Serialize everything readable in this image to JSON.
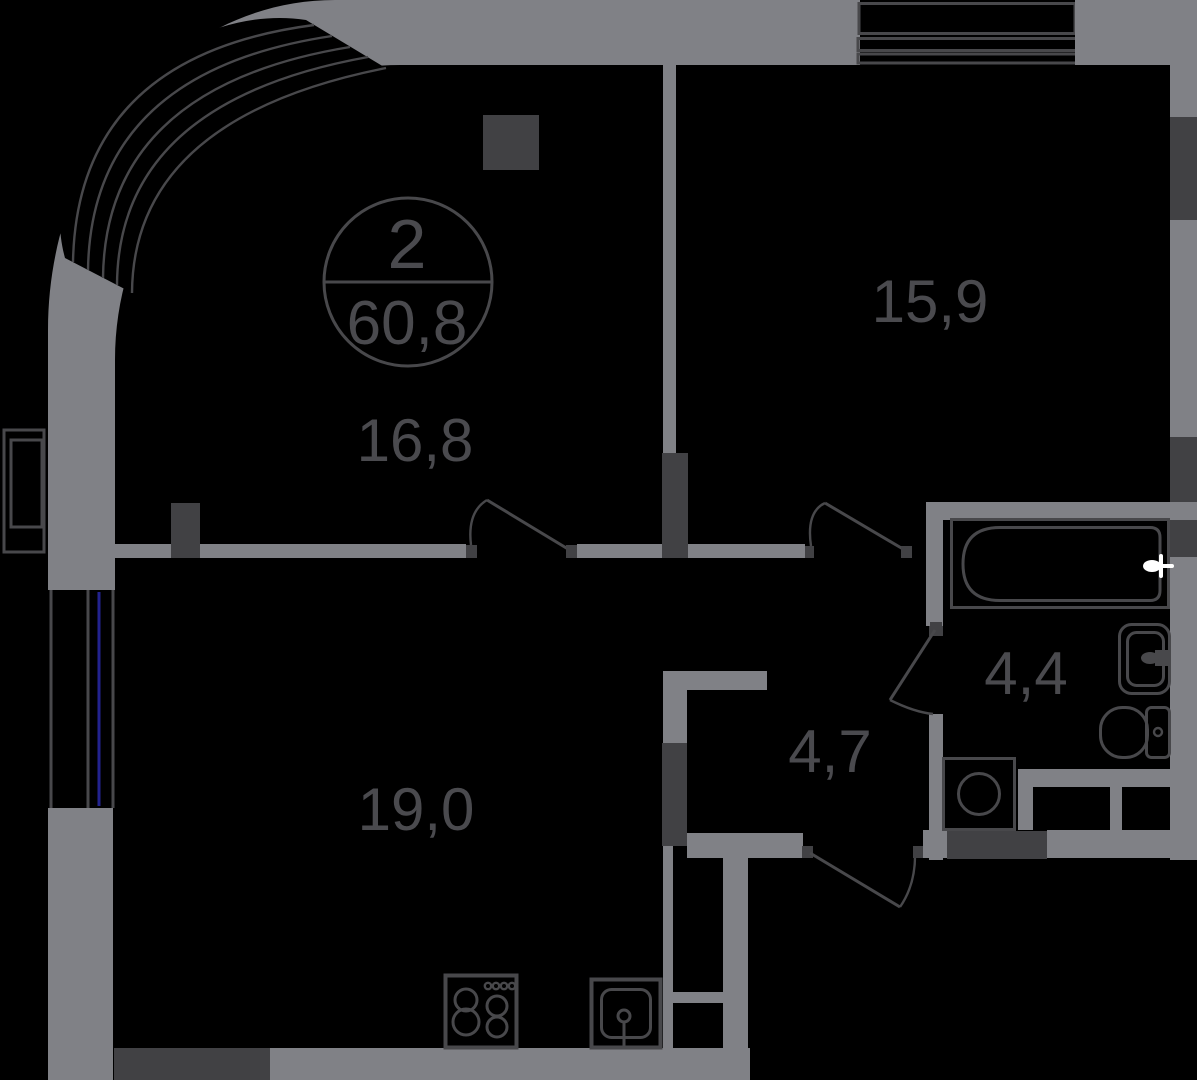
{
  "plan": {
    "stamp": {
      "rooms_count": "2",
      "total_area": "60,8"
    },
    "rooms": [
      {
        "id": "room-top-right",
        "area_label": "15,9"
      },
      {
        "id": "room-top-left",
        "area_label": "16,8"
      },
      {
        "id": "room-bottom-left",
        "area_label": "19,0"
      },
      {
        "id": "bathroom",
        "area_label": "4,4"
      },
      {
        "id": "hallway",
        "area_label": "4,7"
      }
    ],
    "fixtures": [
      "bathtub-icon",
      "washbasin-icon",
      "toilet-icon",
      "washing-machine-icon",
      "stove-icon",
      "kitchen-sink-icon",
      "radiator-icon",
      "column-block",
      "curved-window-glazing",
      "left-window-glazing",
      "balcony-glazing"
    ],
    "palette": {
      "background": "#000000",
      "wall": "#808186",
      "wall_dark": "#414144",
      "line": "#48484b",
      "glass_blue": "#23238f",
      "text": "#4a4a4e",
      "faucet_white": "#ffffff"
    }
  }
}
